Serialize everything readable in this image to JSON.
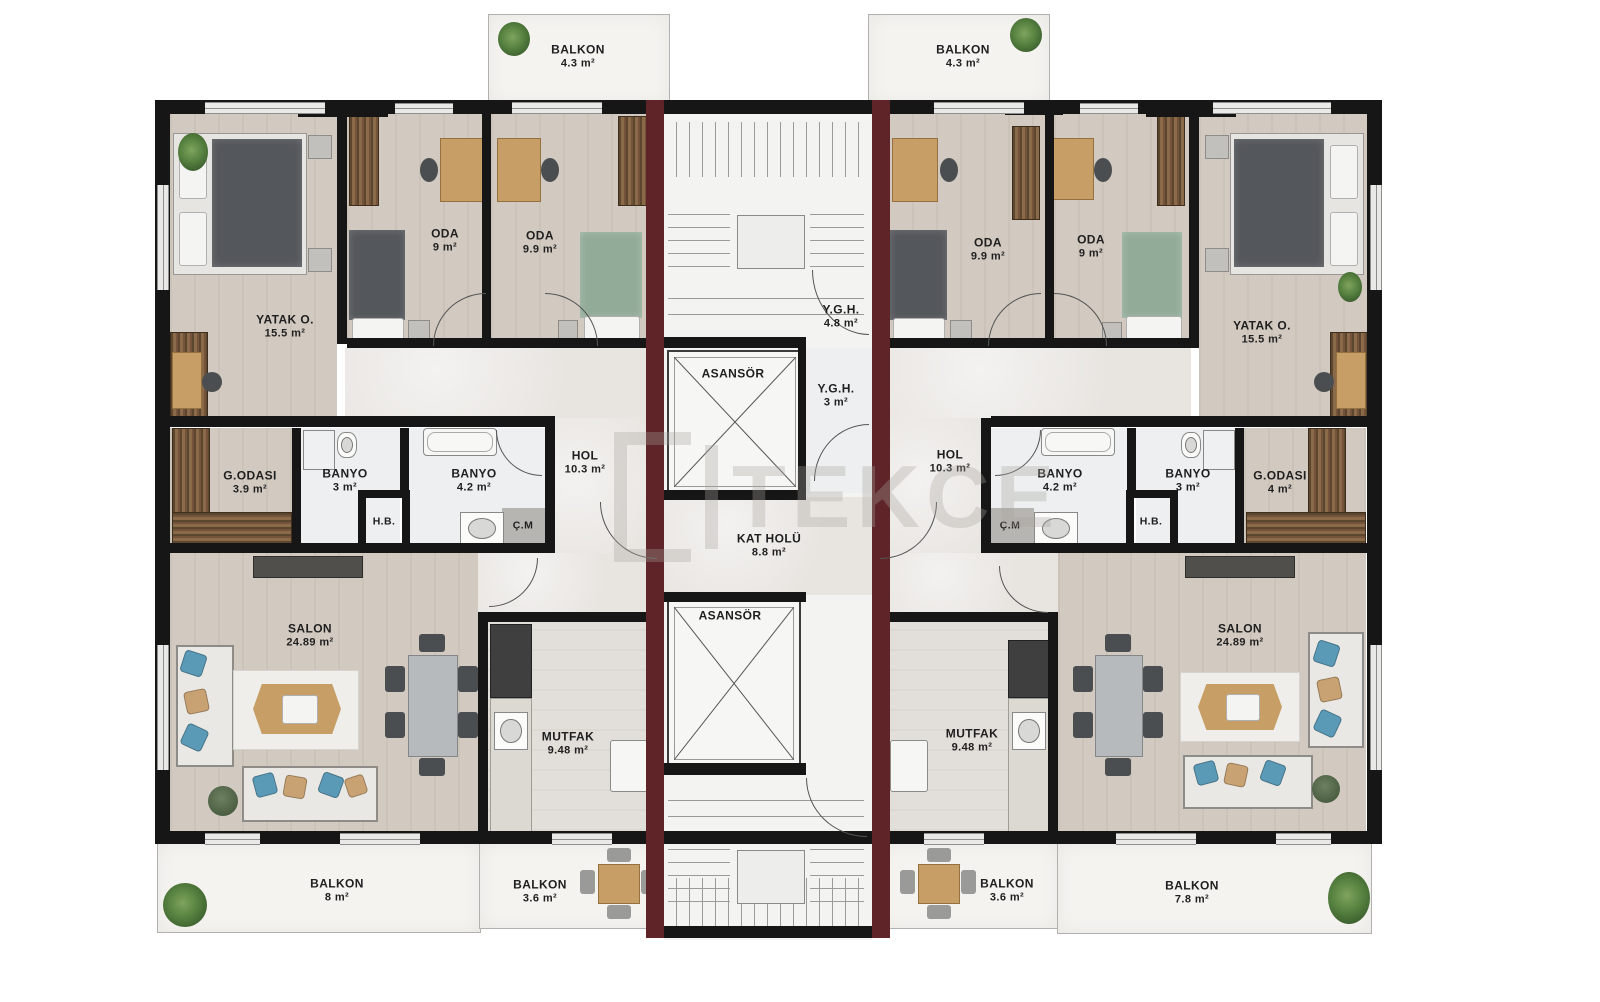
{
  "watermark": "TEKCE",
  "core": {
    "elevator_top": {
      "name": "ASANSÖR"
    },
    "elevator_bottom": {
      "name": "ASANSÖR"
    },
    "ygh_upper": {
      "name": "Y.G.H.",
      "area": "4.8 m²"
    },
    "ygh_lower": {
      "name": "Y.G.H.",
      "area": "3 m²"
    },
    "kat_holu": {
      "name": "KAT HOLÜ",
      "area": "8.8 m²"
    }
  },
  "units": {
    "left": {
      "balkon_top": {
        "name": "BALKON",
        "area": "4.3 m²"
      },
      "yatak": {
        "name": "YATAK O.",
        "area": "15.5 m²"
      },
      "oda_9": {
        "name": "ODA",
        "area": "9 m²"
      },
      "oda_99": {
        "name": "ODA",
        "area": "9.9 m²"
      },
      "godasi": {
        "name": "G.ODASI",
        "area": "3.9 m²"
      },
      "banyo_3": {
        "name": "BANYO",
        "area": "3 m²"
      },
      "hb": {
        "name": "H.B."
      },
      "banyo_42": {
        "name": "BANYO",
        "area": "4.2 m²"
      },
      "cm": {
        "name": "Ç.M"
      },
      "hol": {
        "name": "HOL",
        "area": "10.3 m²"
      },
      "salon": {
        "name": "SALON",
        "area": "24.89 m²"
      },
      "mutfak": {
        "name": "MUTFAK",
        "area": "9.48 m²"
      },
      "balkon_8": {
        "name": "BALKON",
        "area": "8 m²"
      },
      "balkon_36": {
        "name": "BALKON",
        "area": "3.6 m²"
      }
    },
    "right": {
      "balkon_top": {
        "name": "BALKON",
        "area": "4.3 m²"
      },
      "yatak": {
        "name": "YATAK O.",
        "area": "15.5 m²"
      },
      "oda_9": {
        "name": "ODA",
        "area": "9 m²"
      },
      "oda_99": {
        "name": "ODA",
        "area": "9.9 m²"
      },
      "godasi": {
        "name": "G.ODASI",
        "area": "4 m²"
      },
      "banyo_3": {
        "name": "BANYO",
        "area": "3 m²"
      },
      "hb": {
        "name": "H.B."
      },
      "banyo_42": {
        "name": "BANYO",
        "area": "4.2 m²"
      },
      "cm": {
        "name": "Ç.M"
      },
      "hol": {
        "name": "HOL",
        "area": "10.3 m²"
      },
      "salon": {
        "name": "SALON",
        "area": "24.89 m²"
      },
      "mutfak": {
        "name": "MUTFAK",
        "area": "9.48 m²"
      },
      "balkon_36": {
        "name": "BALKON",
        "area": "3.6 m²"
      },
      "balkon_78": {
        "name": "BALKON",
        "area": "7.8 m²"
      }
    }
  }
}
